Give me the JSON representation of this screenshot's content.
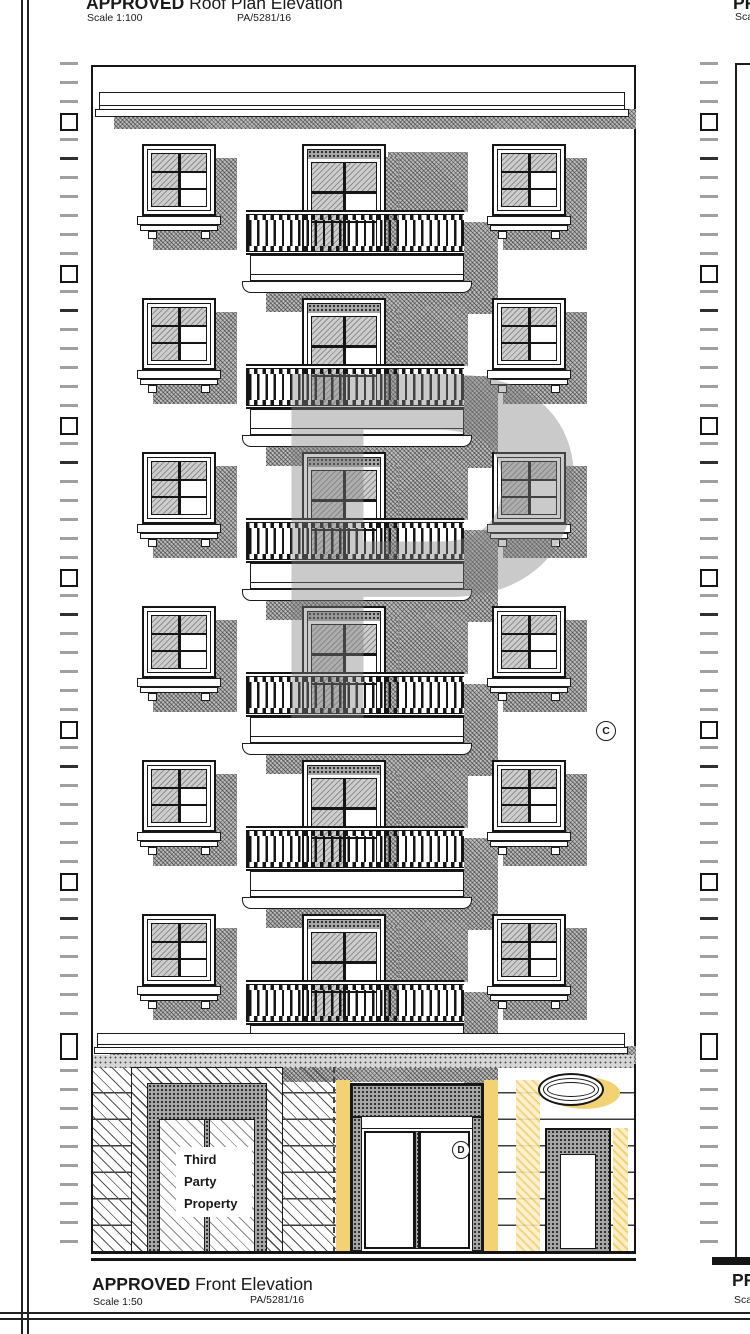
{
  "labels": {
    "top": {
      "tag": "APPROVED",
      "title": " Roof Plan Elevation",
      "scale": "Scale 1:100",
      "ref": "PA/5281/16"
    },
    "bottom": {
      "tag": "APPROVED",
      "title": " Front Elevation",
      "scale": "Scale 1:50",
      "ref": "PA/5281/16"
    },
    "top_right": {
      "tag": "PR",
      "scale": "Sca"
    },
    "bottom_right": {
      "tag": "PR",
      "scale": "Scal"
    }
  },
  "annotations": {
    "marker_c": "C",
    "marker_d": "D",
    "third_party_lines": [
      "Third",
      "Party",
      "Property"
    ]
  },
  "watermark_letter": "P",
  "drawing": {
    "floors": 6,
    "colors": {
      "highlight_yellow": "#F2D273",
      "pale_yellow": "#FBEFCB",
      "shadow_gray": "#BDBDBD",
      "line": "#1C1C1C"
    }
  }
}
